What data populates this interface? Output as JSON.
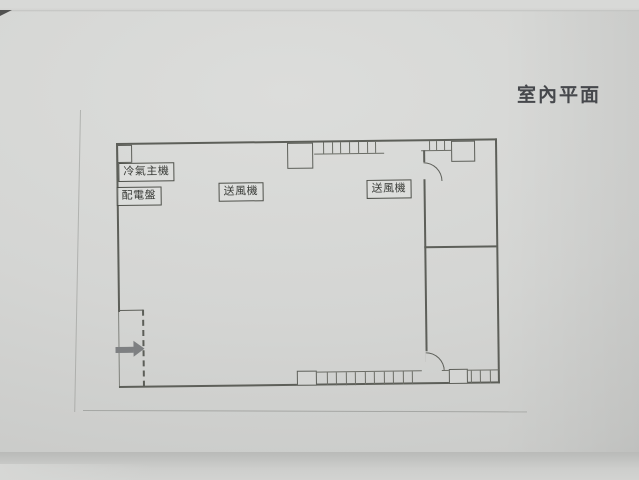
{
  "photo": {
    "title": "室內平面"
  },
  "floor_plan": {
    "equipment_labels": [
      {
        "id": "ac-main-unit",
        "text": "冷氣主機"
      },
      {
        "id": "distribution-panel",
        "text": "配電盤"
      },
      {
        "id": "blower-left",
        "text": "送風機"
      },
      {
        "id": "blower-right",
        "text": "送風機"
      }
    ],
    "entrance": {
      "marker": "arrow-right"
    },
    "colors": {
      "paper": "#d4d5d3",
      "line": "#5d5f59",
      "arrow": "#7e8082",
      "title_text": "#46484c"
    }
  }
}
